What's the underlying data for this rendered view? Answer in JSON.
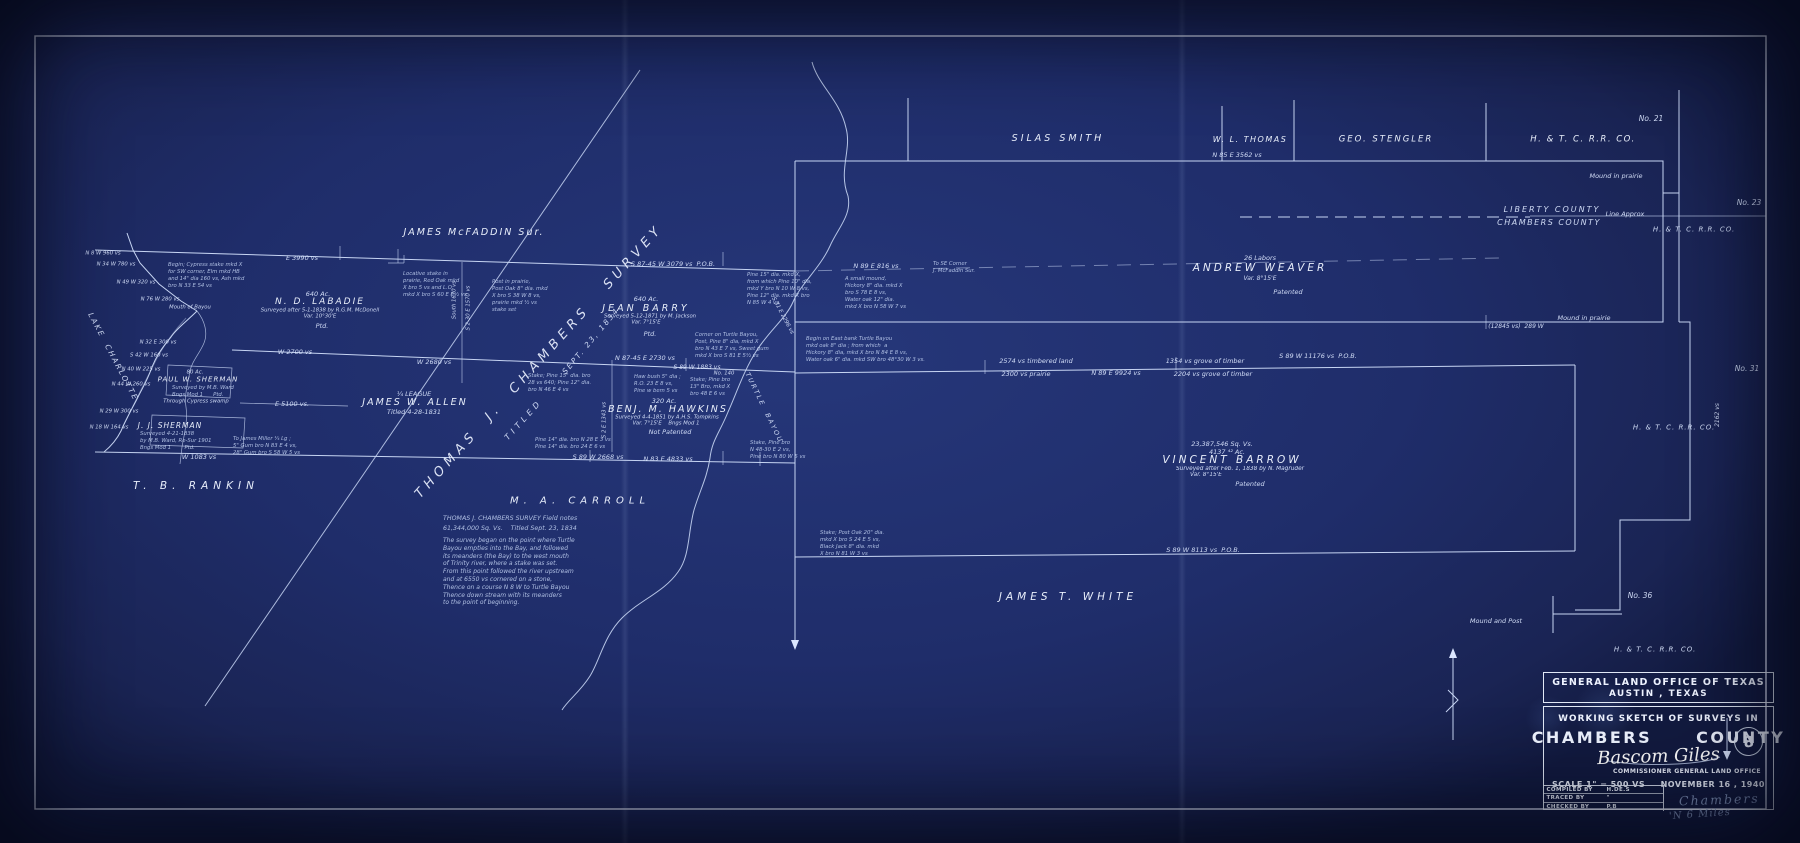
{
  "colors": {
    "paper": "#1f2d6a",
    "ink": "#dce7ff",
    "pencil": "#97abd3"
  },
  "title_block": {
    "agency_line1": "GENERAL LAND OFFICE OF TEXAS",
    "agency_line2": "AUSTIN , TEXAS",
    "sketch_line": "WORKING SKETCH OF SURVEYS IN",
    "county_name": "CHAMBERS",
    "county_word": "COUNTY",
    "signature": "Bascom Giles",
    "signature_title": "COMMISSIONER GENERAL LAND OFFICE",
    "scale": "SCALE 1\" = 500 VS",
    "date": "NOVEMBER 16 , 1940",
    "sheet_number": "8",
    "credits": [
      {
        "label": "COMPILED BY",
        "value": "H.DE.S"
      },
      {
        "label": "TRACED BY",
        "value": "\""
      },
      {
        "label": "CHECKED BY",
        "value": "P.B"
      }
    ],
    "pencil_note1": "Chambers",
    "pencil_note2": "'N 6 Miles"
  },
  "map": {
    "annotations": [
      {
        "t": "SILAS SMITH",
        "x": 1058,
        "y": 139,
        "cls": "name",
        "fs": 9.5,
        "ls": 3,
        "name": "tract-label-silas-smith"
      },
      {
        "t": "W. L. THOMAS",
        "x": 1250,
        "y": 140,
        "cls": "name",
        "fs": 8,
        "ls": 1.5,
        "name": "tract-label-wl-thomas"
      },
      {
        "t": "GEO. STENGLER",
        "x": 1386,
        "y": 140,
        "cls": "name",
        "fs": 8.5,
        "ls": 2,
        "name": "tract-label-geo-stengler"
      },
      {
        "t": "H. & T. C. R.R. CO.",
        "x": 1583,
        "y": 140,
        "cls": "name",
        "fs": 8.5,
        "ls": 1.5,
        "name": "tract-label-htc-rr-top"
      },
      {
        "t": "No. 21",
        "x": 1651,
        "y": 119,
        "fs": 7.5
      },
      {
        "t": "Mound in prairie",
        "x": 1616,
        "y": 176,
        "fs": 6.5
      },
      {
        "t": "N 85 E 3562 vs",
        "x": 1237,
        "y": 155,
        "fs": 6.5
      },
      {
        "t": "LIBERTY COUNTY",
        "x": 1552,
        "y": 210,
        "fs": 8,
        "ls": 2,
        "name": "county-label-liberty"
      },
      {
        "t": "CHAMBERS COUNTY",
        "x": 1549,
        "y": 223,
        "fs": 8,
        "ls": 1.5,
        "name": "county-label-chambers"
      },
      {
        "t": "Line Approx",
        "x": 1625,
        "y": 214,
        "fs": 6.5
      },
      {
        "t": "No. 23",
        "x": 1749,
        "y": 203,
        "fs": 7.5
      },
      {
        "t": "H. & T. C. R.R. CO.",
        "x": 1694,
        "y": 230,
        "fs": 7,
        "ls": 1
      },
      {
        "t": "26 Labors",
        "x": 1260,
        "y": 258,
        "fs": 6.5
      },
      {
        "t": "ANDREW WEAVER",
        "x": 1260,
        "y": 269,
        "cls": "name",
        "fs": 10.5,
        "ls": 3,
        "name": "tract-label-andrew-weaver"
      },
      {
        "t": "Var. 8°15'E",
        "x": 1260,
        "y": 279,
        "fs": 6
      },
      {
        "t": "Patented",
        "x": 1288,
        "y": 292,
        "fs": 6.5
      },
      {
        "t": "Mound in prairie",
        "x": 1584,
        "y": 318,
        "fs": 6.5
      },
      {
        "t": "(12845 vs)  289 W",
        "x": 1516,
        "y": 327,
        "fs": 6
      },
      {
        "t": "No. 31",
        "x": 1747,
        "y": 369,
        "fs": 7.5
      },
      {
        "t": "S 89 W 11176 vs  P.O.B.",
        "x": 1318,
        "y": 356,
        "fs": 6.5
      },
      {
        "t": "2574 vs timbered land",
        "x": 1036,
        "y": 361,
        "fs": 6.5
      },
      {
        "t": "2300 vs prairie",
        "x": 1026,
        "y": 374,
        "fs": 6.5
      },
      {
        "t": "N 89 E 9924 vs",
        "x": 1116,
        "y": 373,
        "fs": 6.5
      },
      {
        "t": "1354 vs grove of timber",
        "x": 1205,
        "y": 361,
        "fs": 6.5
      },
      {
        "t": "2204 vs grove of timber",
        "x": 1213,
        "y": 374,
        "fs": 6.5
      },
      {
        "t": "23,387,546 Sq. Vs.",
        "x": 1222,
        "y": 444,
        "fs": 6.5
      },
      {
        "t": "4137 ⁴² Ac.",
        "x": 1227,
        "y": 452,
        "fs": 6.5
      },
      {
        "t": "VINCENT BARROW",
        "x": 1232,
        "y": 461,
        "cls": "name",
        "fs": 10.5,
        "ls": 3,
        "name": "tract-label-vincent-barrow"
      },
      {
        "t": "Surveyed after Feb. 1, 1838 by N. Magruder",
        "x": 1240,
        "y": 470,
        "fs": 5.8
      },
      {
        "t": "Var. 8°15'E",
        "x": 1206,
        "y": 476,
        "fs": 5.8
      },
      {
        "t": "Patented",
        "x": 1250,
        "y": 484,
        "fs": 6.5
      },
      {
        "t": "S 89 W 8113 vs  P.O.B.",
        "x": 1203,
        "y": 550,
        "fs": 6.5
      },
      {
        "t": "Mound and Post",
        "x": 1496,
        "y": 621,
        "fs": 6.5
      },
      {
        "t": "No. 36",
        "x": 1640,
        "y": 596,
        "fs": 7.5
      },
      {
        "t": "H. & T. C. R.R. CO.",
        "x": 1674,
        "y": 428,
        "fs": 7,
        "ls": 1
      },
      {
        "t": "H. & T. C. R.R. CO.",
        "x": 1655,
        "y": 650,
        "fs": 7,
        "ls": 1
      },
      {
        "t": "JAMES T. WHITE",
        "x": 1068,
        "y": 598,
        "cls": "name",
        "fs": 10.5,
        "ls": 4,
        "name": "tract-label-james-t-white"
      },
      {
        "t": "2162 vs",
        "x": 1718,
        "y": 415,
        "fs": 6,
        "r": -90
      },
      {
        "t": "Stake; Post Oak 20\" dia.\nmkd X bro S 24 E 5 vs,\nBlack Jack 8\" dia. mkd\nX bro N 81 W 3 vs",
        "x": 820,
        "y": 530,
        "cls": "note",
        "al": "l"
      },
      {
        "t": "JAMES McFADDIN Sur.",
        "x": 474,
        "y": 233,
        "cls": "name",
        "fs": 9.5,
        "ls": 2,
        "name": "tract-label-james-mcfaddin"
      },
      {
        "t": "E 3990 vs",
        "x": 302,
        "y": 258,
        "fs": 6.5
      },
      {
        "t": "To SE Corner\nJ. McFaddin Sur.",
        "x": 933,
        "y": 261,
        "cls": "note",
        "al": "l"
      },
      {
        "t": "S 87-45 W 3079 vs  P.O.B.",
        "x": 673,
        "y": 264,
        "fs": 6.5
      },
      {
        "t": "N 89 E 816 vs",
        "x": 876,
        "y": 266,
        "fs": 6.5
      },
      {
        "t": "640 Ac.",
        "x": 318,
        "y": 294,
        "fs": 6.5
      },
      {
        "t": "N. D. LABADIE",
        "x": 320,
        "y": 303,
        "cls": "name",
        "fs": 9,
        "ls": 2,
        "name": "tract-label-nd-labadie"
      },
      {
        "t": "Surveyed after 5-1-1838 by R.G.M. McDonell",
        "x": 320,
        "y": 311,
        "fs": 5.3
      },
      {
        "t": "Var. 10°30'E",
        "x": 320,
        "y": 317,
        "fs": 5.3
      },
      {
        "t": "Ptd.",
        "x": 322,
        "y": 326,
        "fs": 6.5
      },
      {
        "t": "Locative stake in\nprairie, Red Oak mkd\nX bro 5 vs and L.O.\nmkd X bro S 60 E 8½ vs",
        "x": 403,
        "y": 271,
        "cls": "note",
        "al": "l"
      },
      {
        "t": "Post in prairie,\nPost Oak 8\" dia. mkd\nX bro S 38 W 8 vs,\nprairie mkd ½ vs\nstake set",
        "x": 492,
        "y": 279,
        "cls": "note",
        "al": "l"
      },
      {
        "t": "640 Ac.",
        "x": 646,
        "y": 299,
        "fs": 6.5
      },
      {
        "t": "JEAN BARRY",
        "x": 646,
        "y": 309,
        "cls": "name",
        "fs": 9.5,
        "ls": 3,
        "name": "tract-label-jean-barry"
      },
      {
        "t": "Surveyed 5-12-1871 by M. Jackson",
        "x": 650,
        "y": 317,
        "fs": 5.3
      },
      {
        "t": "Var. 7°15'E",
        "x": 646,
        "y": 323,
        "fs": 5.3
      },
      {
        "t": "Ptd.",
        "x": 650,
        "y": 334,
        "fs": 6.5
      },
      {
        "t": "THOMAS  J.  CHAMBERS   SURVEY",
        "x": 540,
        "y": 362,
        "r": -48,
        "cls": "diag",
        "fs": 13,
        "ls": 5,
        "name": "survey-label-thomas-j-chambers"
      },
      {
        "t": "SEPT. 23, 1834",
        "x": 591,
        "y": 341,
        "r": -50,
        "fs": 7.5,
        "ls": 2
      },
      {
        "t": "TITLED",
        "x": 524,
        "y": 420,
        "r": -48,
        "fs": 8,
        "ls": 4
      },
      {
        "t": "¼ LEAGUE",
        "x": 414,
        "y": 394,
        "fs": 6.5
      },
      {
        "t": "JAMES W. ALLEN",
        "x": 415,
        "y": 403,
        "cls": "name",
        "fs": 9.5,
        "ls": 2,
        "name": "tract-label-james-w-allen"
      },
      {
        "t": "Titled 4-28-1831",
        "x": 414,
        "y": 412,
        "fs": 6.5
      },
      {
        "t": "W 2680 vs",
        "x": 434,
        "y": 362,
        "fs": 6.5
      },
      {
        "t": "W 2700 vs",
        "x": 295,
        "y": 352,
        "fs": 6.5
      },
      {
        "t": "320 Ac.",
        "x": 664,
        "y": 401,
        "fs": 6.5
      },
      {
        "t": "BENJ. M. HAWKINS",
        "x": 668,
        "y": 410,
        "cls": "name",
        "fs": 9.5,
        "ls": 2,
        "name": "tract-label-benj-m-hawkins"
      },
      {
        "t": "Surveyed 4-4-1851 by A.H.S. Tompkins",
        "x": 667,
        "y": 418,
        "fs": 5.3
      },
      {
        "t": "Var. 7°15'E    Bngs Mod 1",
        "x": 666,
        "y": 424,
        "fs": 5.3
      },
      {
        "t": "Not Patented",
        "x": 670,
        "y": 432,
        "fs": 6.5
      },
      {
        "t": "N 87-45 E 2730 vs",
        "x": 645,
        "y": 358,
        "fs": 6.5
      },
      {
        "t": "S 89 W 1883 vs",
        "x": 697,
        "y": 368,
        "fs": 6
      },
      {
        "t": "No. 140",
        "x": 724,
        "y": 374,
        "fs": 5.3
      },
      {
        "t": "Haw bush 5\" dia ;\nR.O. 23 E 8 vs,\nPine w bem 5 vs",
        "x": 634,
        "y": 374,
        "cls": "note",
        "al": "l"
      },
      {
        "t": "Stake; Pine 15\" dia. bro\n28 vs 640; Pine 12\" dia.\nbro N 46 E 4 vs",
        "x": 528,
        "y": 373,
        "cls": "note",
        "al": "l"
      },
      {
        "t": "Stake; Pine bro\n13\" Bro, mkd X\nbro 48 E 6 vs",
        "x": 690,
        "y": 377,
        "cls": "note",
        "al": "l"
      },
      {
        "t": "Corner on Turtle Bayou,\nPost, Pine 8\" dia, mkd X\nbro N 43 E 7 vs, Sweet gum\nmkd X bro S 81 E 5½ vs",
        "x": 695,
        "y": 332,
        "cls": "note",
        "al": "l"
      },
      {
        "t": "Pine 15\" dia. mkd X,\nfrom which Pine 10\" dia,\nmkd Y bro N 10 W 8 vs,\nPine 12\" dia. mkd X bro\nN 85 W 4 vs.",
        "x": 747,
        "y": 272,
        "cls": "note",
        "al": "l"
      },
      {
        "t": "A small mound,\nHickory 8\" dia. mkd X\nbro S 78 E 8 vs,\nWater oak 12\" dia.\nmkd X bro N 58 W 7 vs",
        "x": 845,
        "y": 276,
        "cls": "note",
        "al": "l"
      },
      {
        "t": "Begin on East bank Turtle Bayou\nmkd oak 8\" dia ; from which  a\nHickory 8\" dia, mkd X bro N 84 E 8 vs,\nWater oak 6\" dia. mkd SW bro 48°30 W 3 vs.",
        "x": 806,
        "y": 336,
        "cls": "note",
        "al": "l"
      },
      {
        "t": "TURTLE  BAYOU",
        "x": 764,
        "y": 408,
        "r": 64,
        "fs": 6.5,
        "ls": 2,
        "name": "turtle-bayou-label"
      },
      {
        "t": "S 31 E 2296 vs",
        "x": 782,
        "y": 316,
        "r": 62,
        "fs": 5.5
      },
      {
        "t": "M. A. CARROLL",
        "x": 580,
        "y": 501,
        "cls": "name",
        "fs": 10,
        "ls": 5,
        "name": "tract-label-ma-carroll"
      },
      {
        "t": "THOMAS J. CHAMBERS SURVEY Field notes",
        "x": 443,
        "y": 515,
        "cls": "note",
        "al": "l",
        "fs": 6.3
      },
      {
        "t": "61,344,000 Sq. Vs.    Titled Sept. 23, 1834",
        "x": 443,
        "y": 525,
        "cls": "note",
        "al": "l",
        "fs": 6.3
      },
      {
        "t": "The survey began on the point where Turtle\nBayou empties into the Bay, and followed\nits meanders (the Bay) to the west mouth\nof Trinity river, where a stake was set.\nFrom this point followed the river upstream\nand at 6550 vs cornered on a stone,\nThence on a course N 8 W to Turtle Bayou\nThence down stream with its meanders\nto the point of beginning.",
        "x": 443,
        "y": 537,
        "cls": "note",
        "al": "l",
        "fs": 6
      },
      {
        "t": "Pine 14\" dia. bro N 28 E 3 vs\nPine 14\" dia. bro 24 E 6 vs",
        "x": 535,
        "y": 437,
        "cls": "note",
        "al": "l"
      },
      {
        "t": "Stake, Pine bro\nN 48-30 E 2 vs,\nPine bro N 80 W 5 vs",
        "x": 750,
        "y": 440,
        "cls": "note",
        "al": "l"
      },
      {
        "t": "S 89 W 2668 vs",
        "x": 598,
        "y": 457,
        "fs": 6.5
      },
      {
        "t": "N 83 E 4833 vs",
        "x": 668,
        "y": 459,
        "fs": 6.5
      },
      {
        "t": "E 5100 vs.",
        "x": 292,
        "y": 404,
        "fs": 6.5
      },
      {
        "t": "T. B. RANKIN",
        "x": 196,
        "y": 487,
        "cls": "name",
        "fs": 10.5,
        "ls": 5,
        "name": "tract-label-tb-rankin"
      },
      {
        "t": "LAKE  CHARLOTTE",
        "x": 113,
        "y": 357,
        "r": 62,
        "fs": 7.5,
        "ls": 2,
        "name": "lake-charlotte-label"
      },
      {
        "t": "N 8 W 960 vs",
        "x": 103,
        "y": 254,
        "fs": 5.3
      },
      {
        "t": "N 34 W 780 vs",
        "x": 116,
        "y": 265,
        "fs": 5.3
      },
      {
        "t": "N 49 W 320 vs",
        "x": 136,
        "y": 283,
        "fs": 5.3
      },
      {
        "t": "N 76 W 280 vs",
        "x": 160,
        "y": 300,
        "fs": 5.3
      },
      {
        "t": "Mouth of Bayou",
        "x": 190,
        "y": 308,
        "fs": 5.3
      },
      {
        "t": "Begin; Cypress stake mkd X\nfor SW corner, Elm mkd HB\nand 14\" dia 160 vs, Ash mkd\nbro N 33 E 54 vs",
        "x": 168,
        "y": 262,
        "cls": "note",
        "al": "l"
      },
      {
        "t": "N 32 E 300 vs",
        "x": 158,
        "y": 343,
        "fs": 5.3
      },
      {
        "t": "S 42 W 160 vs",
        "x": 149,
        "y": 356,
        "fs": 5.3
      },
      {
        "t": "N 40 W 225 vs",
        "x": 141,
        "y": 370,
        "fs": 5.3
      },
      {
        "t": "N 44 W 260 vs",
        "x": 131,
        "y": 385,
        "fs": 5.3
      },
      {
        "t": "N 29 W 300 vs",
        "x": 119,
        "y": 412,
        "fs": 5.3
      },
      {
        "t": "N 18 W 164 vs",
        "x": 109,
        "y": 428,
        "fs": 5.3
      },
      {
        "t": "80 Ac.",
        "x": 195,
        "y": 373,
        "fs": 5.3
      },
      {
        "t": "PAUL W. SHERMAN",
        "x": 198,
        "y": 380,
        "cls": "name",
        "fs": 7,
        "ls": 1,
        "name": "tract-label-paul-w-sherman"
      },
      {
        "t": "Surveyed by M.B. Ward\nBngs Mod 1      Ptd.",
        "x": 172,
        "y": 385,
        "cls": "note",
        "al": "l"
      },
      {
        "t": "Through Cypress swamp",
        "x": 196,
        "y": 402,
        "fs": 5.3
      },
      {
        "t": "J. J. SHERMAN",
        "x": 170,
        "y": 426,
        "cls": "name",
        "fs": 7.5,
        "ls": 1,
        "name": "tract-label-jj-sherman"
      },
      {
        "t": "Surveyed 4-21-1838\nby M.B. Ward, Re-Sur 1901\nBngs Mod 1        Ptd.",
        "x": 140,
        "y": 431,
        "cls": "note",
        "al": "l"
      },
      {
        "t": "To James Miller ¼ Lg ;\n5\" Gum bro N 83 E 4 vs,\n28\" Gum bro S 58 W 5 vs",
        "x": 233,
        "y": 436,
        "cls": "note",
        "al": "l"
      },
      {
        "t": "W 1083 vs",
        "x": 199,
        "y": 457,
        "fs": 6.5
      },
      {
        "t": "South 1670 vs",
        "x": 455,
        "y": 300,
        "r": -90,
        "fs": 5.3
      },
      {
        "t": "S 2-30 E 1570 vs",
        "x": 469,
        "y": 308,
        "r": -90,
        "fs": 5.3
      },
      {
        "t": "S 2 E 1343 vs",
        "x": 605,
        "y": 420,
        "r": -90,
        "fs": 5.3
      }
    ]
  }
}
